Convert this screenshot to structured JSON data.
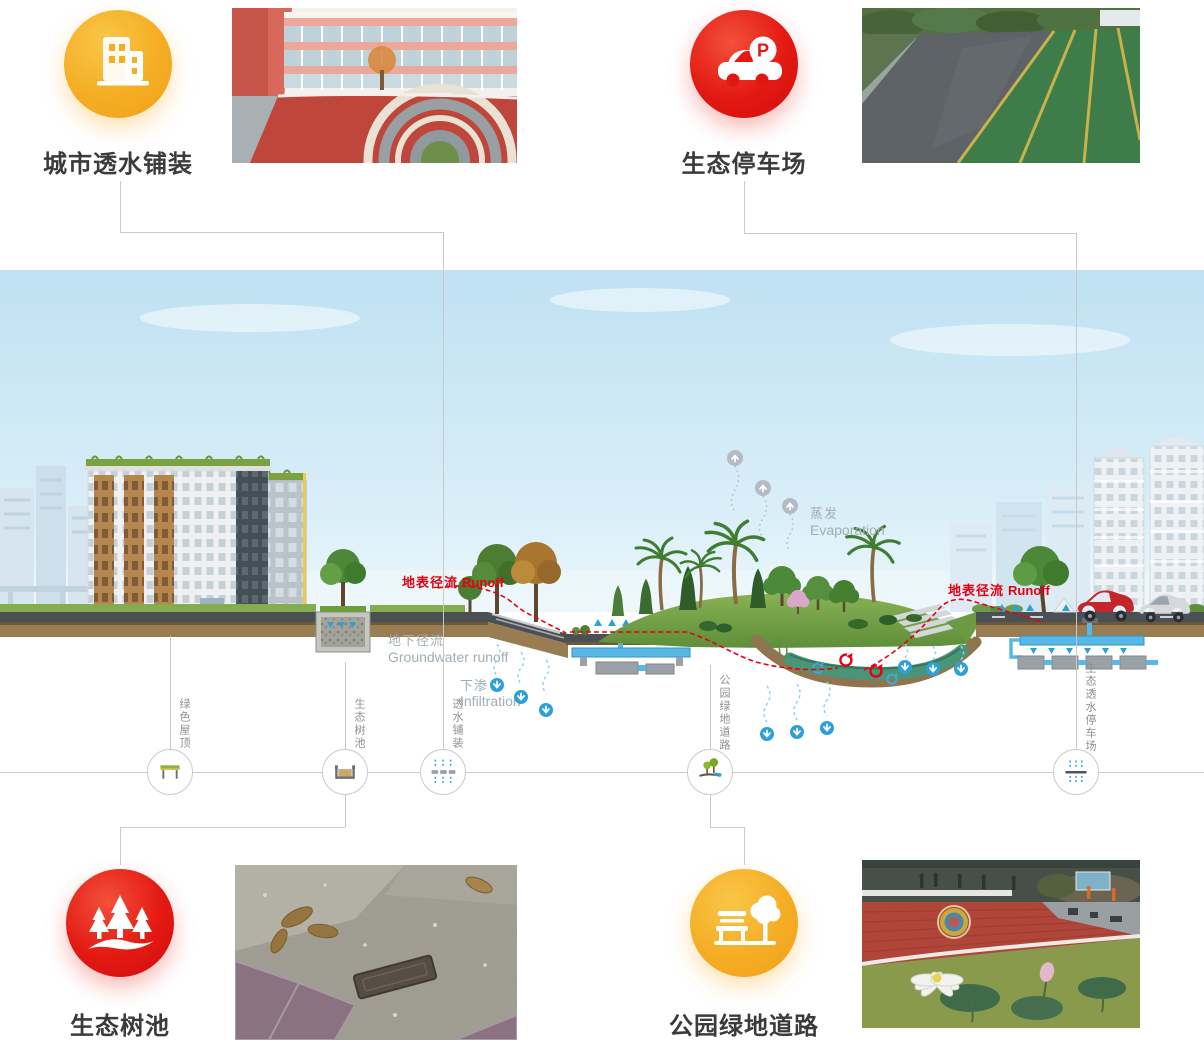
{
  "features": {
    "urban_permeable_paving": {
      "label": "城市透水铺装"
    },
    "eco_parking_lot": {
      "label": "生态停车场",
      "icon_letter": "P"
    },
    "eco_tree_pit": {
      "label": "生态树池"
    },
    "park_greenway": {
      "label": "公园绿地道路"
    }
  },
  "diagram": {
    "markers": [
      {
        "label": "绿色屋顶"
      },
      {
        "label": "生态树池"
      },
      {
        "label": "透水铺装"
      },
      {
        "label": "公园绿地道路"
      },
      {
        "label": "生态透水停车场"
      }
    ],
    "annotations": {
      "surface_runoff_zh": "地表径流",
      "surface_runoff_en": "Runoff",
      "groundwater_zh": "地下径流",
      "groundwater_en": "Groundwater runoff",
      "infiltration_zh": "下渗",
      "infiltration_en": "Infiltration",
      "evaporation_zh": "蒸发",
      "evaporation_en": "Evaporation"
    }
  },
  "colors": {
    "accent_yellow": "#f5ad24",
    "accent_red": "#e31912",
    "annotation_red": "#e60012",
    "annotation_gray": "#a2adb4",
    "water_blue": "#2f9fd8",
    "connector": "#c9c9c9"
  }
}
